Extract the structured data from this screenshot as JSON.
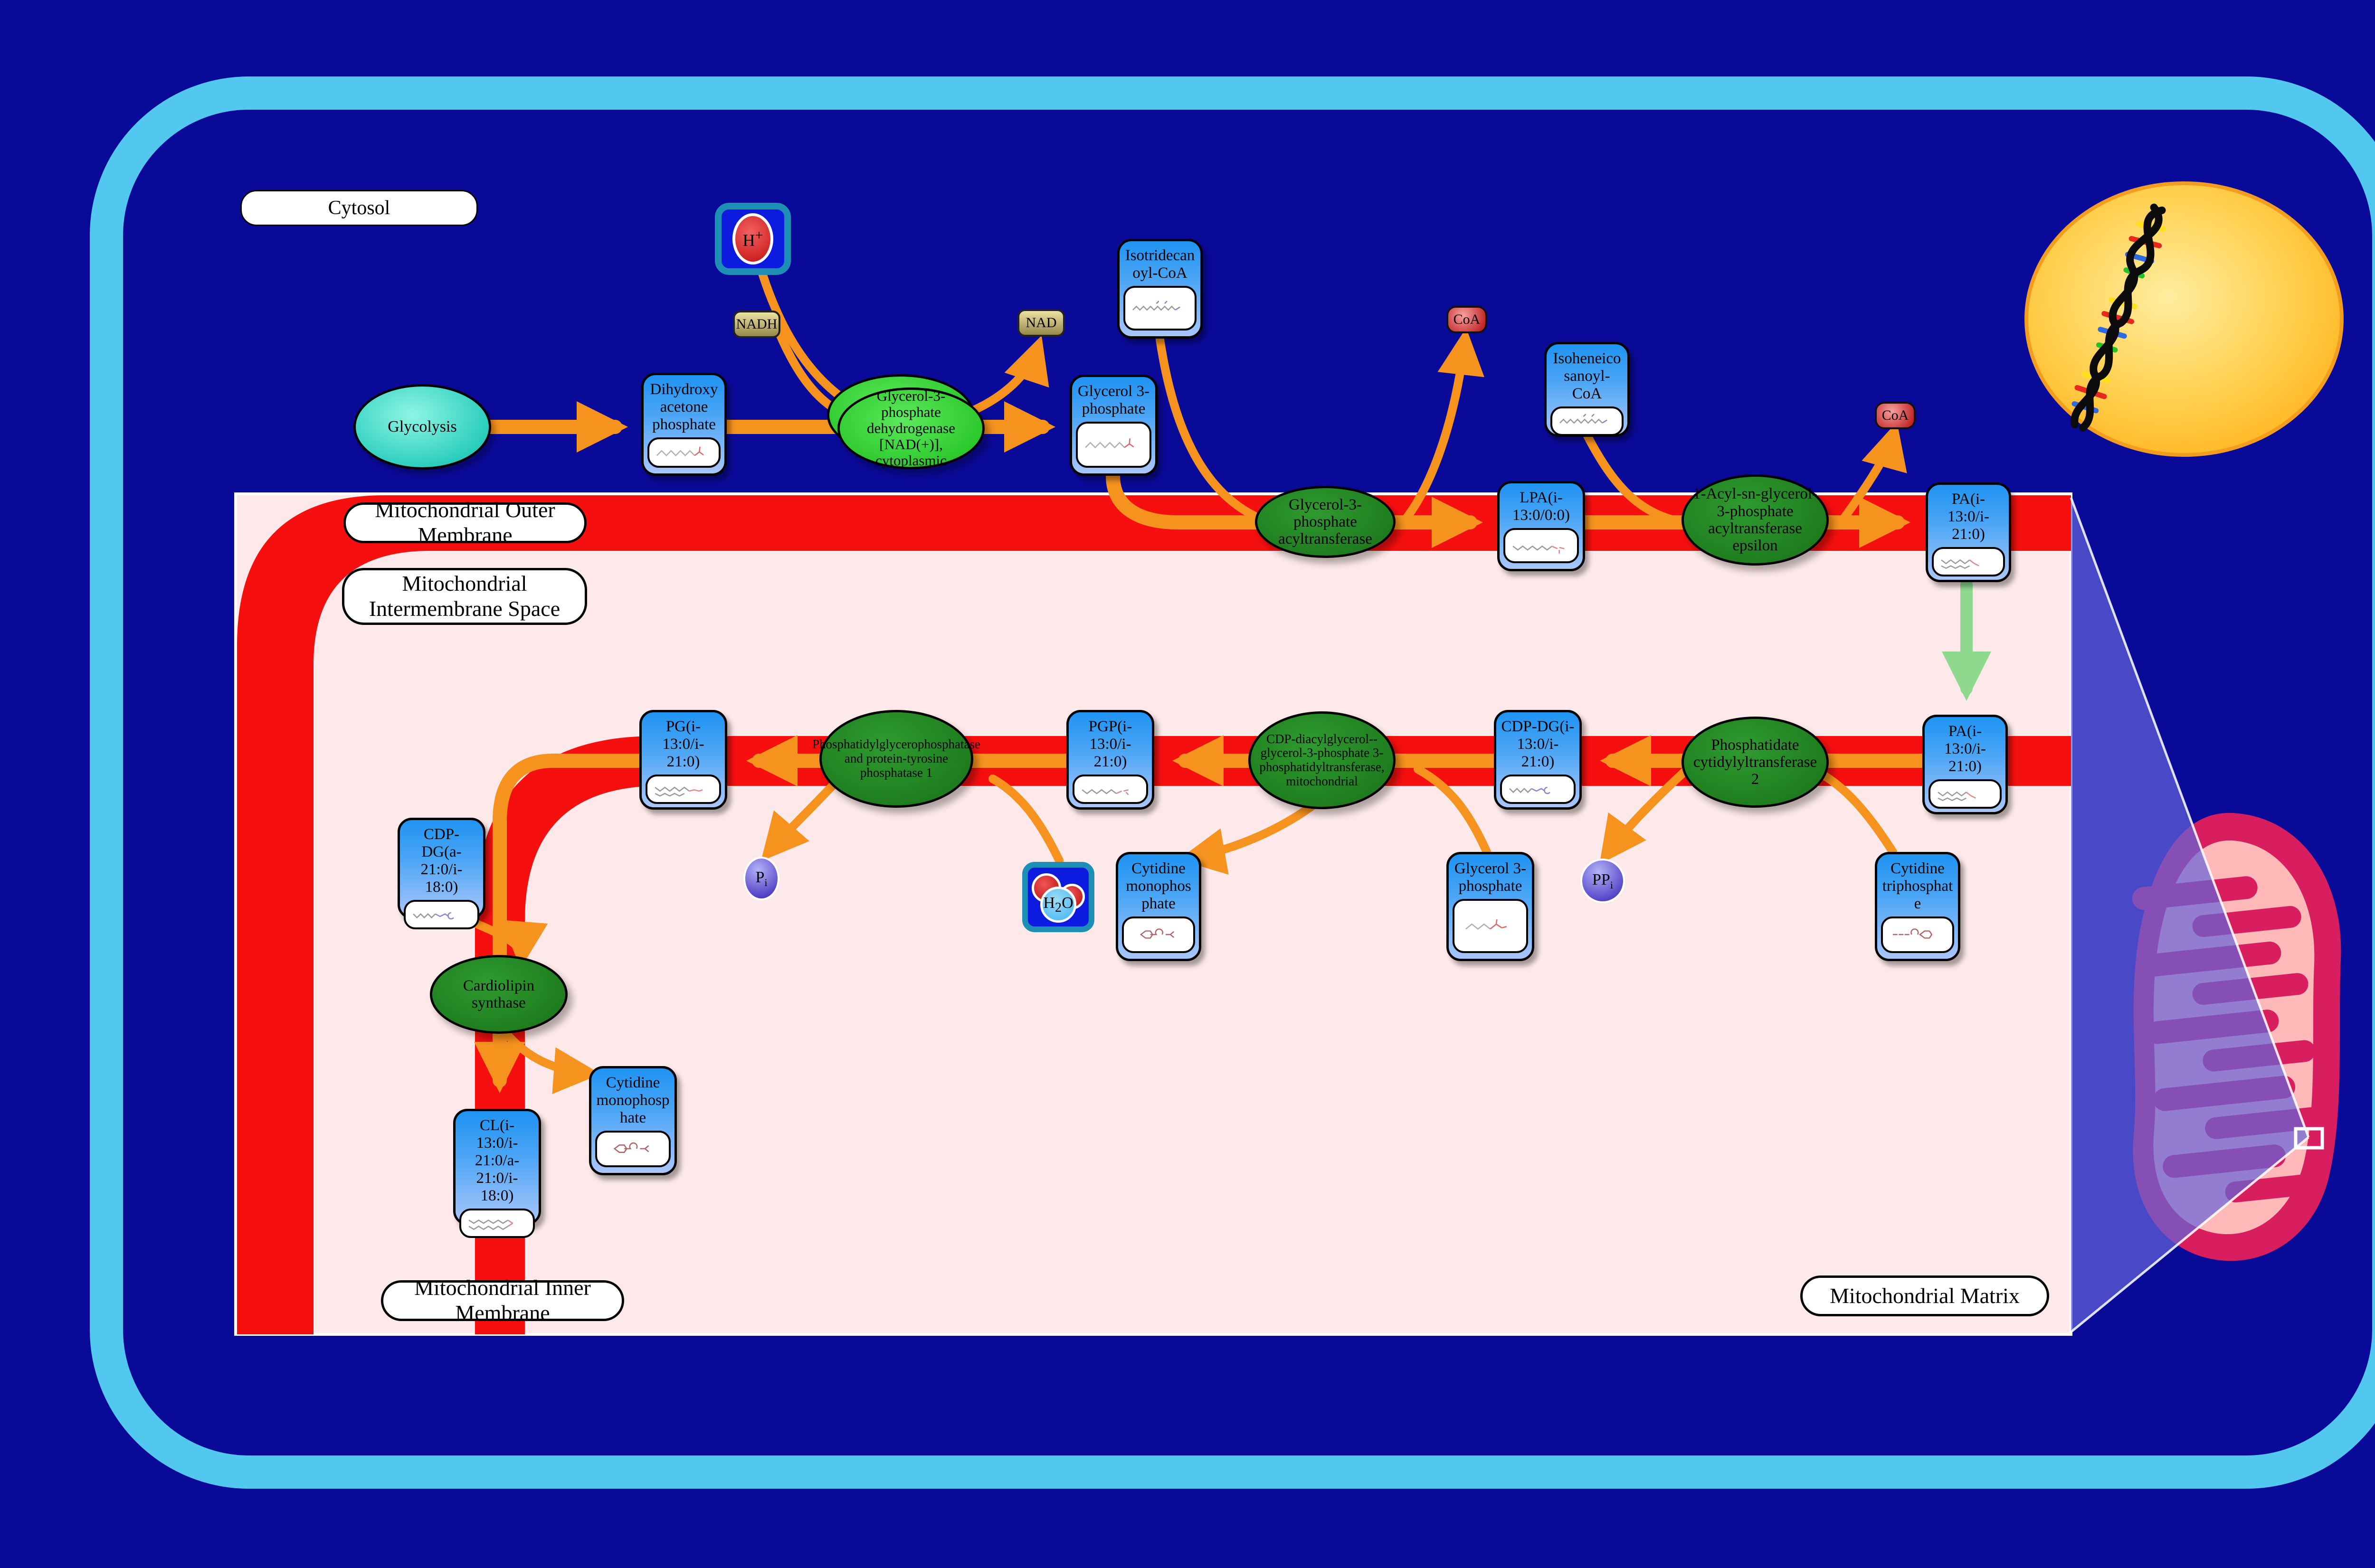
{
  "regions": {
    "cytosol": "Cytosol",
    "outer_membrane": "Mitochondrial Outer Membrane",
    "intermembrane_space": "Mitochondrial Intermembrane Space",
    "inner_membrane": "Mitochondrial Inner Membrane",
    "matrix": "Mitochondrial Matrix"
  },
  "process": {
    "glycolysis": "Glycolysis"
  },
  "enzymes": {
    "gpd1": "Glycerol-3-phosphate dehydrogenase [NAD(+)], cytoplasmic",
    "gpat": "Glycerol-3-phosphate acyltransferase",
    "agpat": "1-Acyl-sn-glycerol-3-phosphate acyltransferase epsilon",
    "cds2": "Phosphatidate cytidylyltransferase 2",
    "pgs1": "CDP-diacylglycerol--glycerol-3-phosphate 3-phosphatidyltransferase, mitochondrial",
    "ptpmt1": "Phosphatidylglycerophosphatase and protein-tyrosine phosphatase 1",
    "crls1": "Cardiolipin synthase"
  },
  "metabolites": {
    "dhap": "Dihydroxyacetone phosphate",
    "g3p_top": "Glycerol 3-phosphate",
    "isotridecanoyl_coa": "Isotridecanoyl-CoA",
    "isoheneicosanoyl_coa": "Isoheneicosanoyl-CoA",
    "lpa": "LPA(i-13:0/0:0)",
    "pa_outer": "PA(i-13:0/i-21:0)",
    "pa_inner": "PA(i-13:0/i-21:0)",
    "cdp_dg": "CDP-DG(i-13:0/i-21:0)",
    "pgp": "PGP(i-13:0/i-21:0)",
    "pg": "PG(i-13:0/i-21:0)",
    "cdp_dg_a": "CDP-DG(a-21:0/i-18:0)",
    "cl": "CL(i-13:0/i-21:0/a-21:0/i-18:0)",
    "cmp_left": "Cytidine monophosphate",
    "cmp_mid": "Cytidine monophosphate",
    "g3p_bottom": "Glycerol 3-phosphate",
    "ctp": "Cytidine triphosphate"
  },
  "cofactors": {
    "nadh": "NADH",
    "nad": "NAD",
    "coa_1": "CoA",
    "coa_2": "CoA",
    "h": {
      "base": "H",
      "sup": "+"
    },
    "pi": {
      "base": "P",
      "sub": "i"
    },
    "ppi": {
      "base": "PP",
      "sub": "i"
    },
    "h2o": {
      "base": "H",
      "sub": "2",
      "tail": "O"
    }
  },
  "colors": {
    "background": "#0a0a99",
    "cell_border": "#52c8f0",
    "membrane_red": "#f50f0f",
    "matrix_pink": "#fde9e9",
    "node_blue": "#2e9ef4",
    "enzyme_green": "#1d7a1d",
    "enzyme_bright_green": "#35d435",
    "arrow_orange": "#f6921e",
    "arrow_green": "#8fd98f",
    "nucleus_yellow": "#ffb41e",
    "mitochondrion_crimson": "#d81e5f"
  }
}
